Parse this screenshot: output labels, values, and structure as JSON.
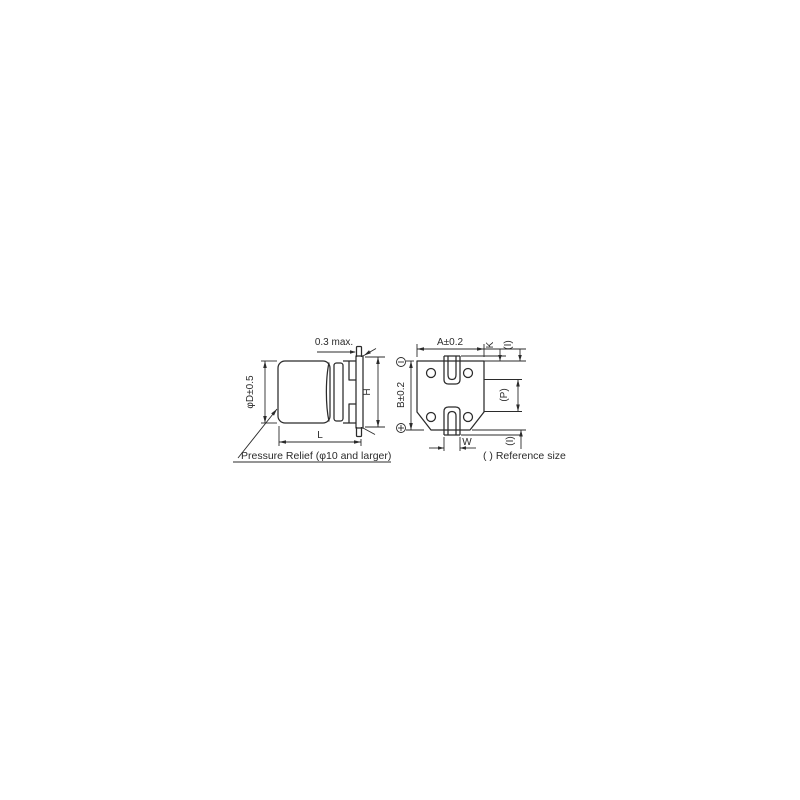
{
  "side_view": {
    "lead_protrusion": "0.3 max.",
    "diameter": "φD±0.5",
    "length": "L",
    "height": "H",
    "pressure_relief_note": "Pressure Relief (φ10 and larger)"
  },
  "bottom_view": {
    "width": "A±0.2",
    "lead_clearance": "K",
    "ref_top": "(I)",
    "depth": "B±0.2",
    "lead_pitch": "(P)",
    "lead_width": "W",
    "ref_bottom": "(I)",
    "icons": {
      "negative_terminal": "circled-minus",
      "positive_terminal": "circled-plus"
    }
  },
  "notes": {
    "reference_size": "( ) Reference size"
  },
  "colors": {
    "line": "#2b2b2b",
    "background": "#ffffff"
  }
}
